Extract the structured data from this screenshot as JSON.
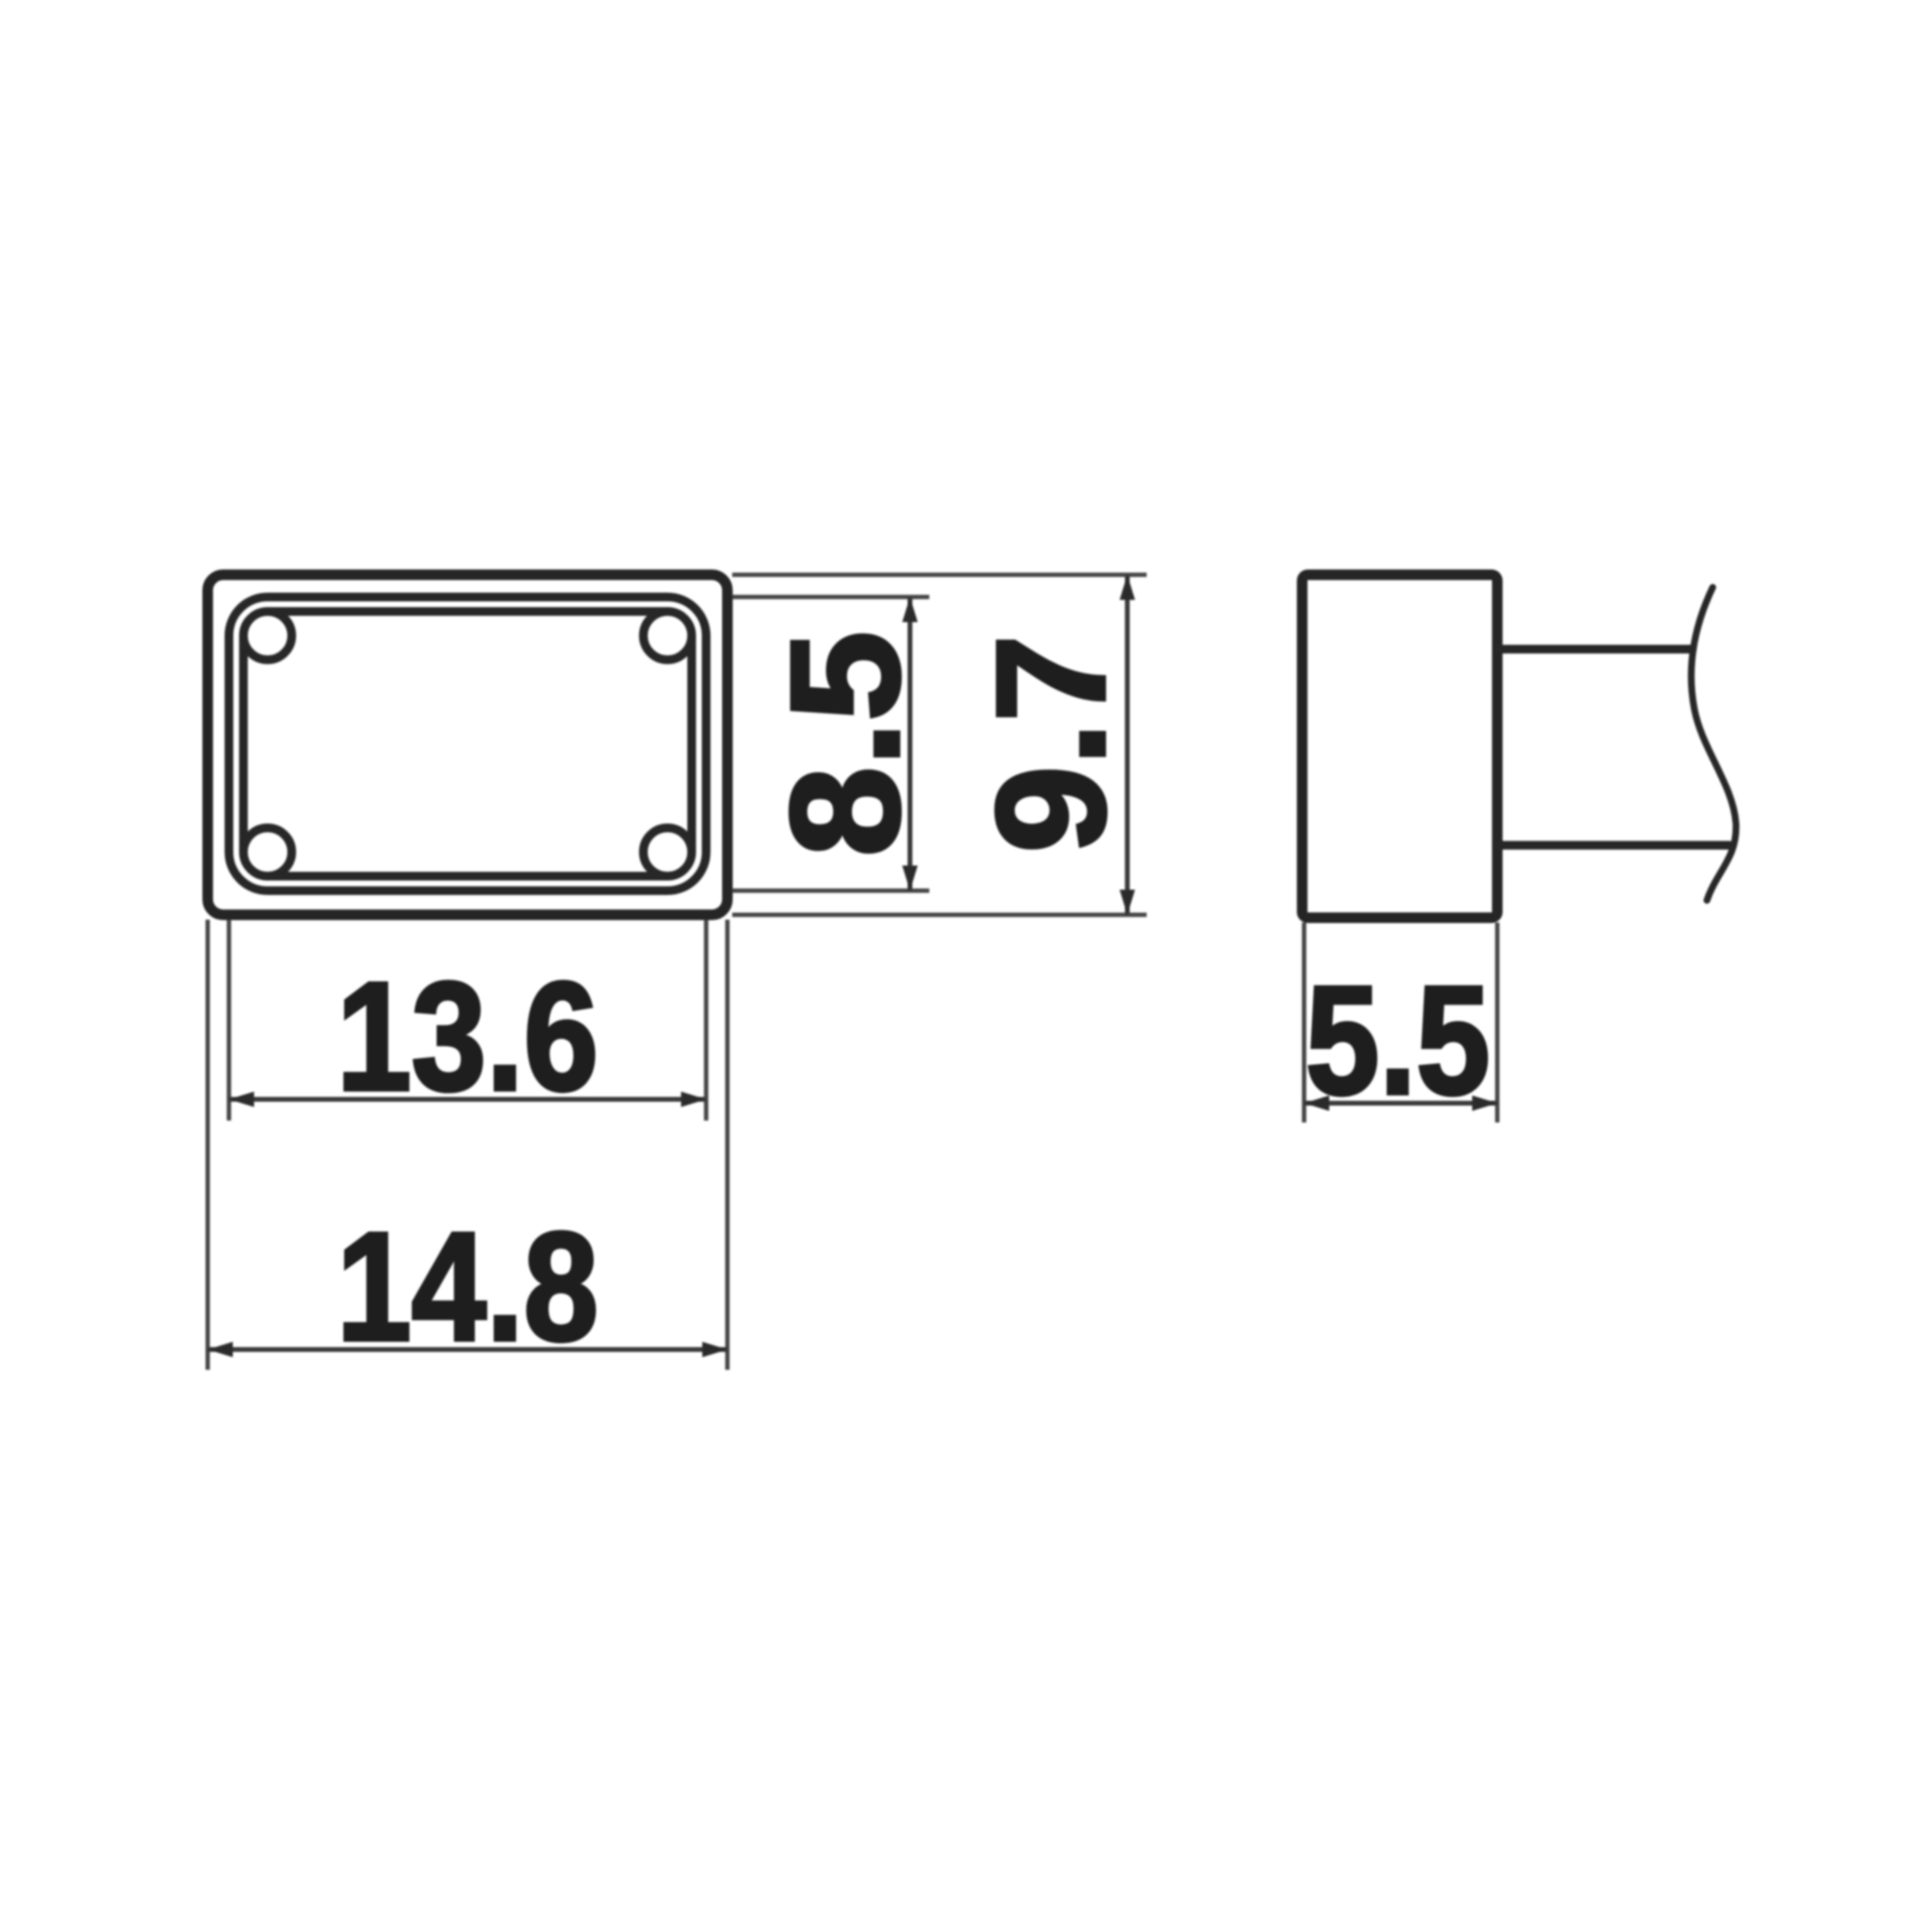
{
  "drawing": {
    "kind": "technical-dimension-drawing",
    "views": {
      "front_view": "rectangular tip face with inner rim and corner reliefs",
      "side_view": "tip profile with shaft and break line"
    },
    "dimensions": {
      "cavity_height": "8.5",
      "overall_height": "9.7",
      "cavity_width": "13.6",
      "overall_width": "14.8",
      "tip_depth": "5.5"
    },
    "colors": {
      "line": "#252525",
      "thin_line": "#3a3a3a",
      "background": "#ffffff"
    }
  }
}
